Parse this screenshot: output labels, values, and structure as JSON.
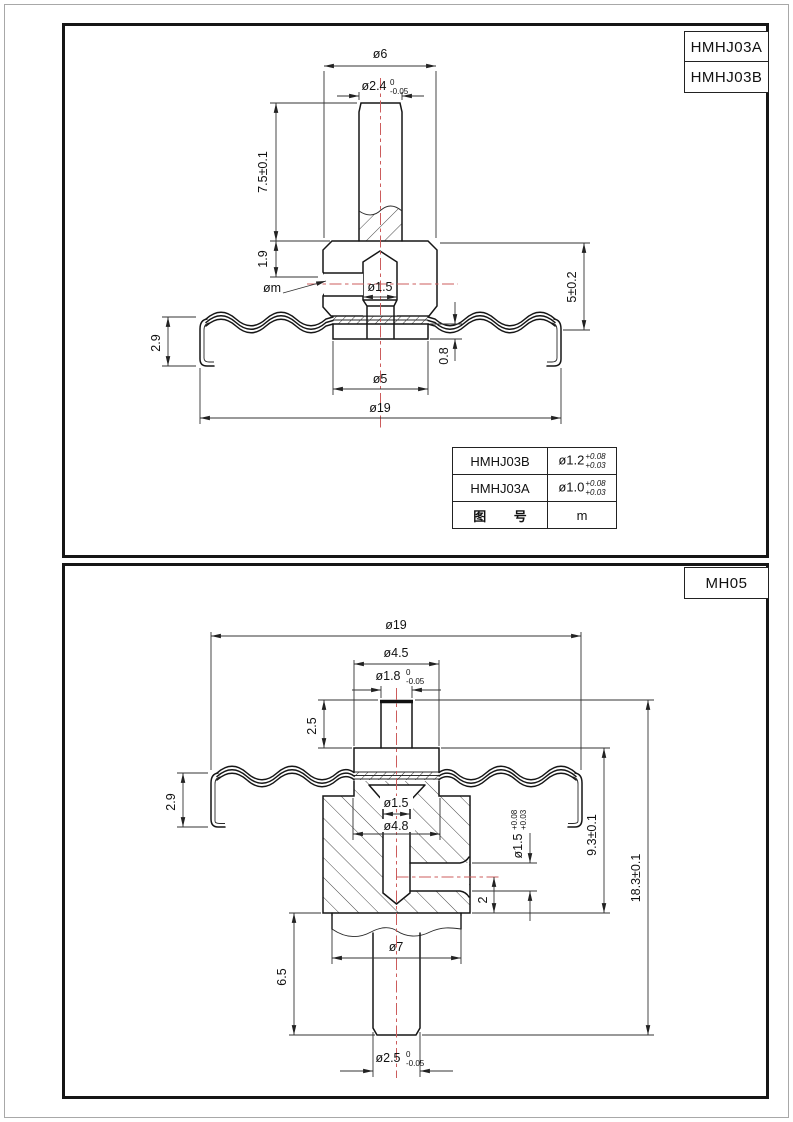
{
  "colors": {
    "line": "#161616",
    "centerline": "#cc5c5c"
  },
  "top_sheet": {
    "part_no_1": "HMHJ03A",
    "part_no_2": "HMHJ03B",
    "dims": {
      "dia6": "ø6",
      "dia24_v": "ø2.4",
      "dia24_up": "0",
      "dia24_dn": "-0.05",
      "len75": "7.5±0.1",
      "len19": "1.9",
      "diam": "øm",
      "dia15": "ø1.5",
      "len5": "5±0.2",
      "len08": "0.8",
      "len29": "2.9",
      "dia5": "ø5",
      "dia19": "ø19"
    },
    "table": {
      "r1_name": "HMHJ03B",
      "r1_v": "ø1.2",
      "r1_up": "+0.08",
      "r1_dn": "+0.03",
      "r2_name": "HMHJ03A",
      "r2_v": "ø1.0",
      "r2_up": "+0.08",
      "r2_dn": "+0.03",
      "r3_name": "图 号",
      "r3_v": "m"
    }
  },
  "bottom_sheet": {
    "part_no": "MH05",
    "dims": {
      "dia19": "ø19",
      "dia45": "ø4.5",
      "dia18_v": "ø1.8",
      "dia18_up": "0",
      "dia18_dn": "-0.05",
      "len25": "2.5",
      "len29": "2.9",
      "dia15": "ø1.5",
      "dia48": "ø4.8",
      "dia15s_v": "ø1.5",
      "dia15s_up": "+0.08",
      "dia15s_dn": "+0.03",
      "len2": "2",
      "len93": "9.3±0.1",
      "len183": "18.3±0.1",
      "len65": "6.5",
      "dia7": "ø7",
      "dia25_v": "ø2.5",
      "dia25_up": "0",
      "dia25_dn": "-0.05"
    }
  }
}
